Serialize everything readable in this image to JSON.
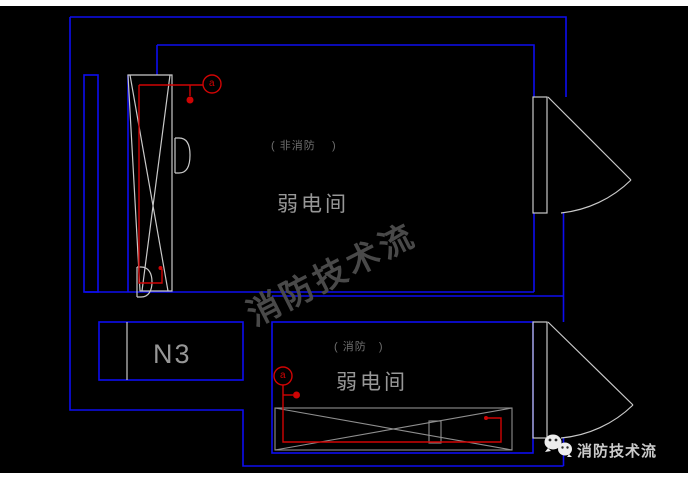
{
  "colors": {
    "wall": "#0d0df0",
    "outline": "#c9c9c9",
    "outline_dim": "#8f8f8f",
    "red": "#cf0404",
    "text_gray": "#979797",
    "text_dim": "#6f6f6f",
    "watermark": "#4d4d4d",
    "wechat_text": "#cbcbcb"
  },
  "rooms": {
    "upper": {
      "type_label": "( 非消防    )",
      "name": "弱电间"
    },
    "lower": {
      "type_label": "( 消防   )",
      "name": "弱电间"
    }
  },
  "labels": {
    "duct": "N3"
  },
  "symbols": {
    "upper_circle": "a",
    "lower_circle": "a"
  },
  "watermark": {
    "text": "消防技术流"
  },
  "footer": {
    "brand": "消防技术流"
  }
}
